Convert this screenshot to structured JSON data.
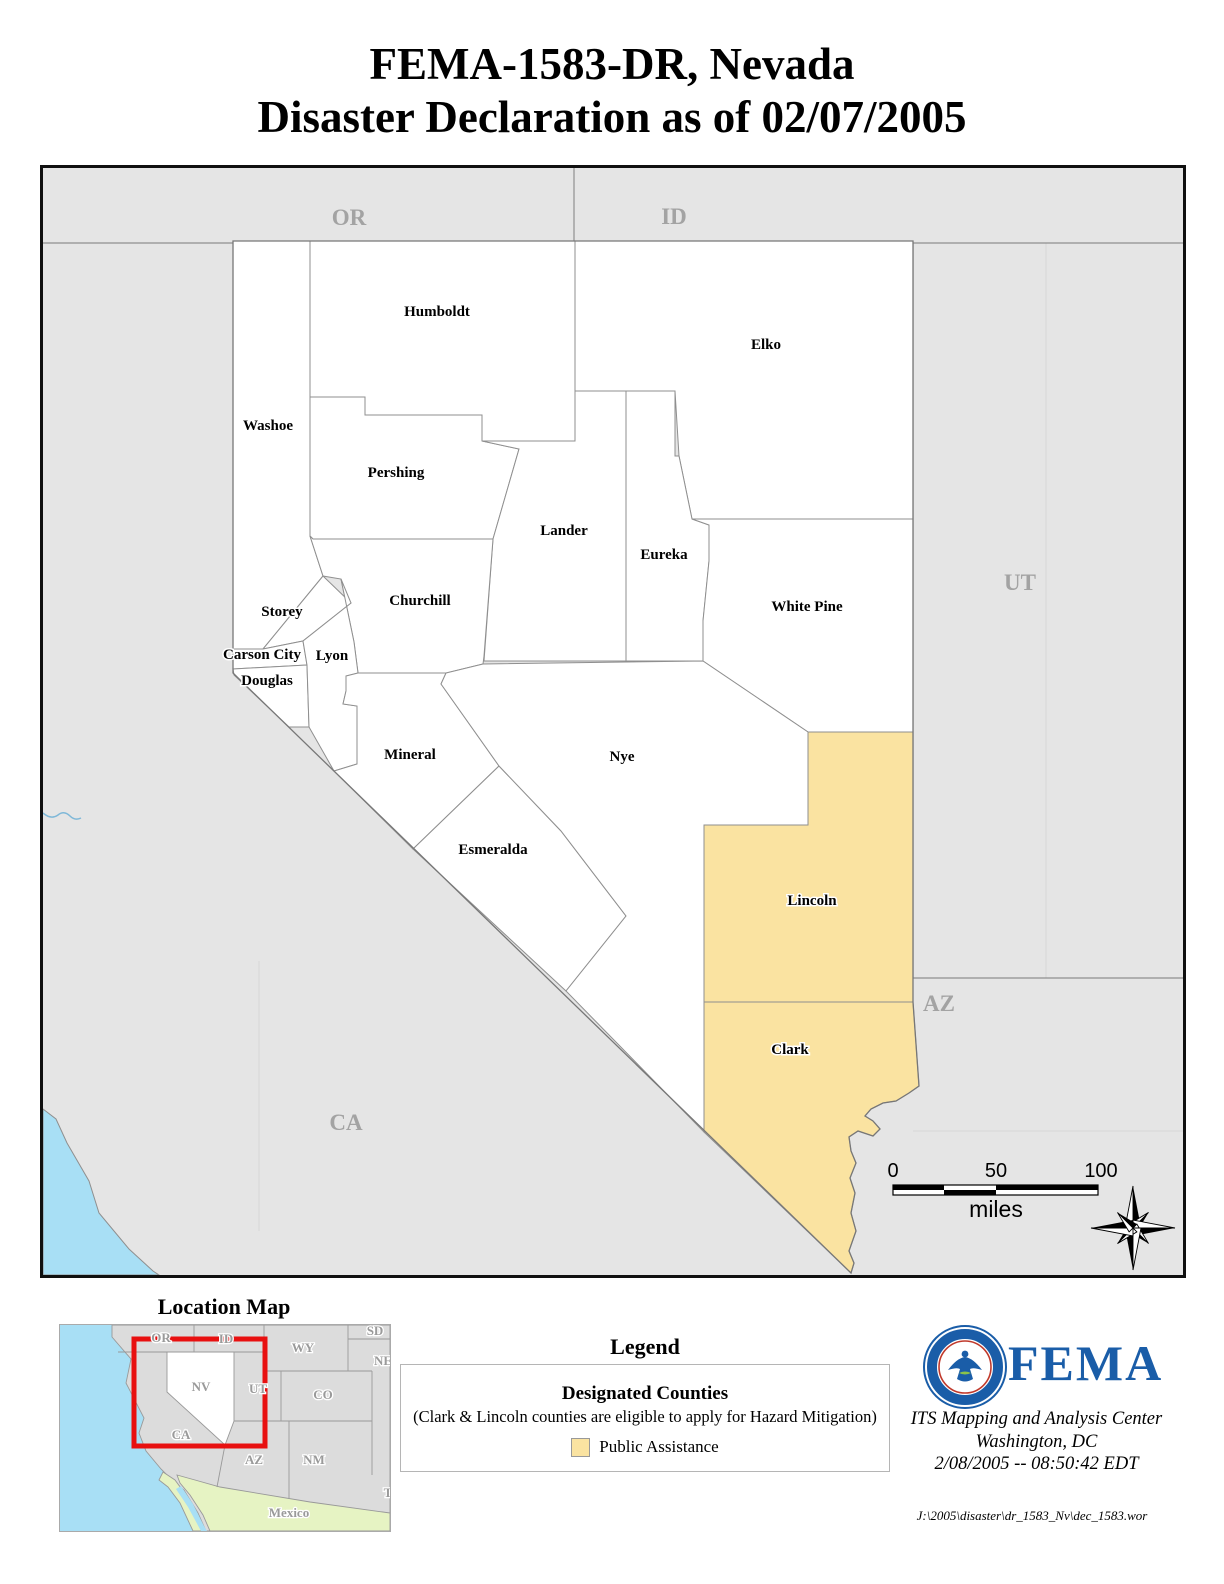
{
  "title": {
    "line1": "FEMA-1583-DR, Nevada",
    "line2": "Disaster Declaration as of 02/07/2005"
  },
  "map": {
    "counties": [
      {
        "label": "Humboldt",
        "designated": false
      },
      {
        "label": "Elko",
        "designated": false
      },
      {
        "label": "Washoe",
        "designated": false
      },
      {
        "label": "Pershing",
        "designated": false
      },
      {
        "label": "Lander",
        "designated": false
      },
      {
        "label": "Eureka",
        "designated": false
      },
      {
        "label": "White Pine",
        "designated": false
      },
      {
        "label": "Churchill",
        "designated": false
      },
      {
        "label": "Storey",
        "designated": false
      },
      {
        "label": "Carson City",
        "designated": false
      },
      {
        "label": "Lyon",
        "designated": false
      },
      {
        "label": "Douglas",
        "designated": false
      },
      {
        "label": "Mineral",
        "designated": false
      },
      {
        "label": "Nye",
        "designated": false
      },
      {
        "label": "Esmeralda",
        "designated": false
      },
      {
        "label": "Lincoln",
        "designated": true
      },
      {
        "label": "Clark",
        "designated": true
      }
    ],
    "state_labels": [
      "OR",
      "ID",
      "UT",
      "AZ",
      "CA"
    ],
    "scale": {
      "t0": "0",
      "t1": "50",
      "t2": "100",
      "unit": "miles"
    }
  },
  "location_map": {
    "title": "Location Map",
    "labels": [
      "OR",
      "ID",
      "WY",
      "SD",
      "NE",
      "NV",
      "UT",
      "CO",
      "CA",
      "AZ",
      "NM",
      "T",
      "Mexico"
    ]
  },
  "legend": {
    "title": "Legend",
    "heading": "Designated Counties",
    "note": "(Clark & Lincoln counties are eligible to apply for Hazard Mitigation)",
    "item_label": "Public Assistance"
  },
  "agency": {
    "name": "FEMA",
    "line1": "ITS Mapping and Analysis Center",
    "line2": "Washington, DC",
    "line3": "2/08/2005  --  08:50:42 EDT"
  },
  "footer": {
    "file_path": "J:\\2005\\disaster\\dr_1583_Nv\\dec_1583.wor"
  },
  "colors": {
    "designated": "#FAE3A1",
    "background_states": "#E5E5E5",
    "water": "#A8DFF5",
    "mexico": "#E6F3C3",
    "fema_blue": "#1A5DA8",
    "locator_red": "#E81010"
  }
}
